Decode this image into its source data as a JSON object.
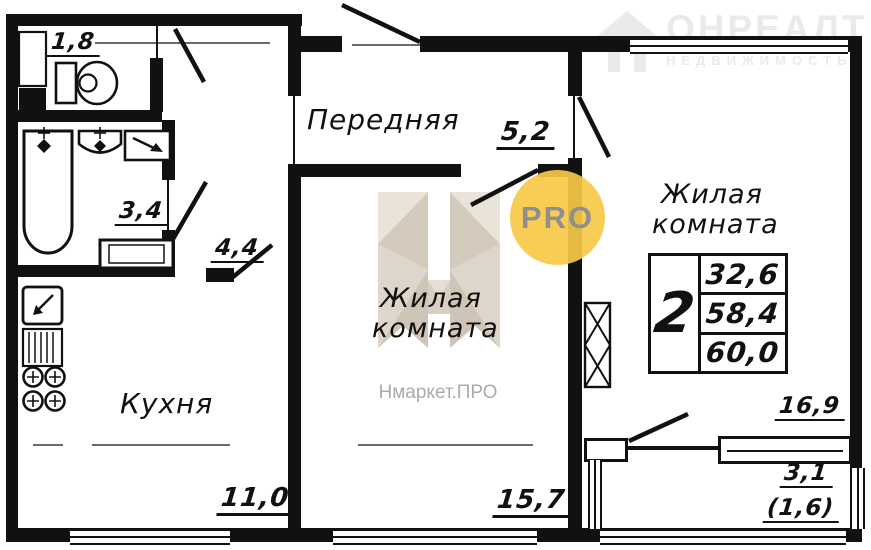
{
  "plan": {
    "rooms": {
      "hallway": {
        "name": "Передняя",
        "area": "5,2"
      },
      "living_center": {
        "name": "Жилая комната",
        "area": "15,7"
      },
      "living_right": {
        "name": "Жилая комната",
        "area": "16,9"
      },
      "kitchen": {
        "name": "Кухня",
        "area": "11,0"
      },
      "wc": {
        "area": "1,8"
      },
      "bathroom": {
        "area": "3,4"
      },
      "corridor": {
        "area": "4,4"
      },
      "balcony": {
        "area": "3,1",
        "area_with_coefficient": "(1,6)"
      }
    },
    "spec_table": {
      "rooms_count": "2",
      "living_area": "32,6",
      "usable_area": "58,4",
      "total_area": "60,0"
    }
  },
  "watermarks": {
    "pro_badge": "PRO",
    "nmarket_text": "Нмаркет.ПРО",
    "onrealt_title": "ОНРЕАЛТ",
    "onrealt_subtitle": "НЕДВИЖИМОСТЬ"
  },
  "colors": {
    "wall": "#111111",
    "pro_yellow": "#f7c948",
    "watermark_beige": "#d9d1c5",
    "watermark_light_gray": "#e8eaec",
    "nmarket_gray": "#ababab"
  }
}
